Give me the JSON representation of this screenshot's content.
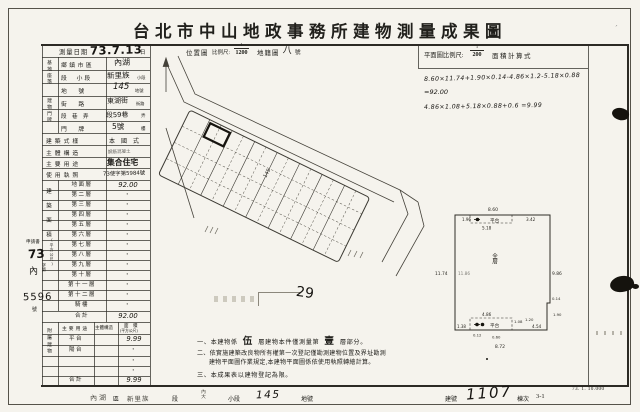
{
  "title": "台北市中山地政事務所建物測量成果圖",
  "print_code": "73. 1. 10.000",
  "header": {
    "survey_date_label": "測量日期",
    "survey_date": "73.7.13",
    "day_suffix": "日",
    "location_map": "位置圖",
    "scale_label": "比例尺:",
    "loc_scale_num": "1",
    "loc_scale_den": "1200",
    "cadastral_label": "地籍圖",
    "cadastral_no": "八",
    "no_suffix": "號",
    "plan_scale_label": "平面圖比例尺:",
    "plan_scale_num": "1",
    "plan_scale_den": "200",
    "area_formula_label": "面積計算式"
  },
  "application": {
    "label": "申請書",
    "year": "73",
    "code": "內",
    "zidi": "字第",
    "number": "5596",
    "suffix": "號"
  },
  "site": {
    "group_label": "基地座落",
    "district_label": "鄉鎮市區",
    "district": "內湖",
    "section_label": "段　小段",
    "section": "新里族",
    "section_suffix": "小段",
    "parcel_label": "地　　號",
    "parcel": "145",
    "parcel_suffix": "地號"
  },
  "address": {
    "group_label": "建物門牌",
    "street_label": "街　　路",
    "street": "東湖街",
    "street_suffix": "街路",
    "lane_label": "段　巷　弄",
    "lane": "段59巷",
    "lane_suffix": "弄",
    "number_label": "門　　牌",
    "number": "5號",
    "number_suffix": "樓"
  },
  "building": {
    "style_label": "建築式樣",
    "style": "本　國　式",
    "structure_label": "主體構造",
    "structure": "鋼筋混凝土",
    "use_label": "主要用途",
    "use": "集合住宅",
    "license_label": "使用執照",
    "license": "73使字第5984號"
  },
  "floor_area": {
    "group_label": "建築面積",
    "group_unit": "(平方公尺)",
    "rows": [
      {
        "label": "地面層",
        "value": "92.00"
      },
      {
        "label": "第二層",
        "value": "・"
      },
      {
        "label": "第三層",
        "value": "・"
      },
      {
        "label": "第四層",
        "value": "・"
      },
      {
        "label": "第五層",
        "value": "・"
      },
      {
        "label": "第六層",
        "value": "・"
      },
      {
        "label": "第七層",
        "value": "・"
      },
      {
        "label": "第八層",
        "value": "・"
      },
      {
        "label": "第九層",
        "value": "・"
      },
      {
        "label": "第十層",
        "value": "・"
      },
      {
        "label": "第十一層",
        "value": "・"
      },
      {
        "label": "第十二層",
        "value": "・"
      },
      {
        "label": "騎樓",
        "value": "・"
      },
      {
        "label": "合計",
        "value": "92.00"
      }
    ]
  },
  "annex": {
    "group_label": "附屬建物",
    "use_header": "主要用途",
    "structure_header": "主體構造",
    "area_header": "面　積",
    "area_header2": "(平方公尺)",
    "rows": [
      {
        "label": "平台",
        "value": "9.99"
      },
      {
        "label": "陽台",
        "value": "・"
      },
      {
        "label": "",
        "value": "・"
      },
      {
        "label": "",
        "value": "・"
      },
      {
        "label": "合計",
        "value": "9.99"
      }
    ]
  },
  "formulas": {
    "line1": "8.60×11.74+1.90×0.14-4.86×1.2-5.18×0.88",
    "line2": "=92.00",
    "line3": "4.86×1.08+5.18×0.88+0.6 =9.99"
  },
  "location_map": {
    "parcel_mark": "145"
  },
  "overlay": {
    "note_number": "29"
  },
  "plan": {
    "platform_label": "平台",
    "center_label": "全層",
    "dims": {
      "top": "8.60",
      "top_left": "1.96",
      "platform_top": "5.18",
      "top_right": "3.42",
      "left": "11.74",
      "left_inner": "11.86",
      "right": "9.86",
      "notch_a": "0.14",
      "notch_b": "1.90",
      "bottom_platform": "4.86",
      "platform_side": "1.08",
      "gap": "1.20",
      "bottom_right": "4.54",
      "bottom_left": "1.38",
      "b1": "0.12",
      "b2": "0.60",
      "bottom": "8.72"
    }
  },
  "notes": {
    "n1a": "一、本建物係",
    "n1_floors": "伍",
    "n1b": "層建物本件僅測量第",
    "n1_count": "壹",
    "n1c": "層部分。",
    "n2a": "二、依實施建築改良物所有權第一次登記僅勘測建物位置及界址勘測",
    "n2b": "建物平面圖作業規定,本建物平面圖係依使用執照轉繪計算。",
    "n3": "三、本成果表以建物登記為限。"
  },
  "footer": {
    "district": "內湖",
    "district_suffix": "區",
    "section": "新里族",
    "section_suffix": "段",
    "subsection": "內大",
    "subsection_suffix": "小段",
    "parcel": "145",
    "parcel_suffix": "地號",
    "building_no_label": "建號",
    "building_no": "1107",
    "unit_label": "棟次",
    "unit": "3-1"
  }
}
